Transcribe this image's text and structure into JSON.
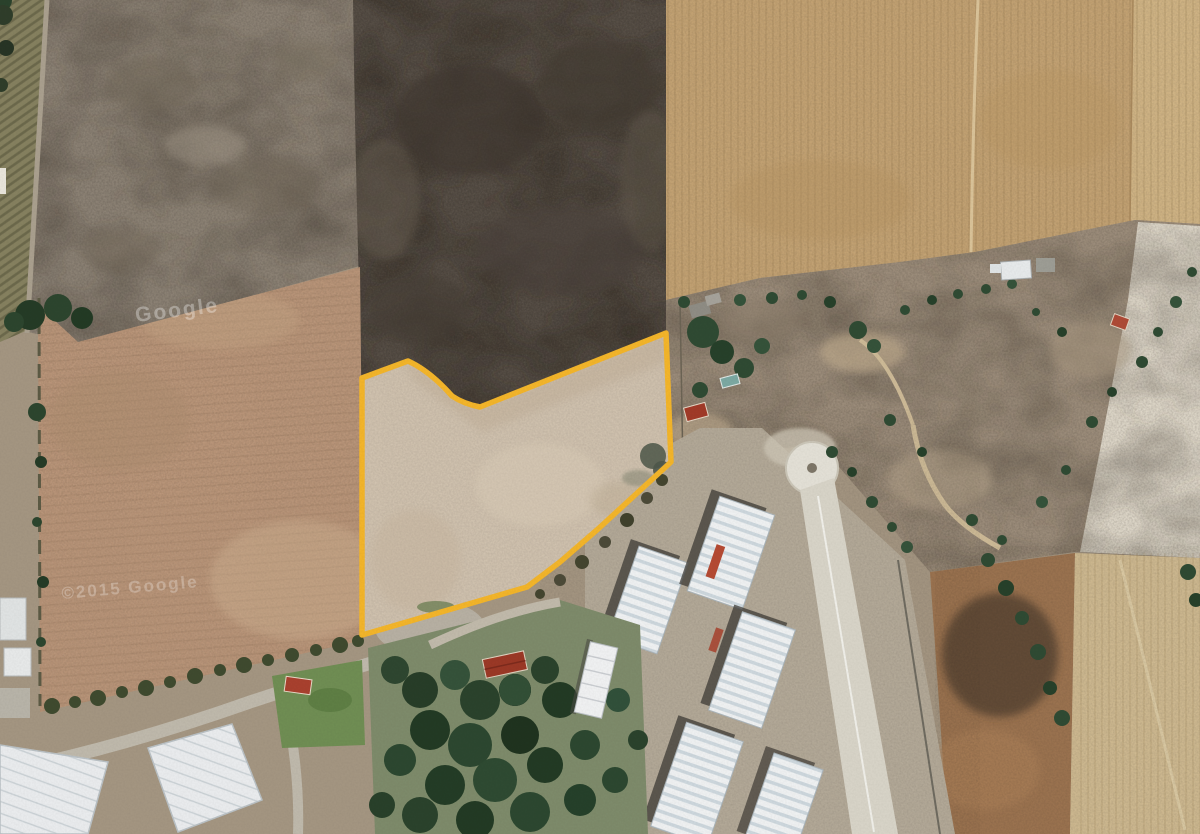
{
  "map": {
    "type": "satellite-imagery",
    "description": "Aerial/satellite view of agricultural land with an irregular parcel highlighted by a yellow boundary; surrounded by plowed fields, dark scrub field, scrubland with scattered trees, industrial warehouses, greenhouses and a wooded lot",
    "watermarks": [
      {
        "text": "Google",
        "position": "upper-left field",
        "style": "faint-white"
      },
      {
        "text": "©2015 Google",
        "position": "middle-left field",
        "style": "faint-white"
      }
    ],
    "parcel": {
      "outline_color": "#F2B42A",
      "outline_width_px": 5,
      "fill_color": "#CFC1AE",
      "shape": "irregular polygon with notch at top-left"
    },
    "palette": {
      "dark_scrub_field": "#544C44",
      "golden_field": "#C2A172",
      "plowed_brown_field": "#B79377",
      "gray_brown_field": "#8B8174",
      "scrubland": "#9C8D7B",
      "cleared_white_area": "#DDD6C8",
      "warehouse_roof": "#EEF0F1",
      "vegetation_dark_green": "#3A5739",
      "lawn_green": "#6F8D53",
      "concrete_pad": "#E2DFD5",
      "red_roof": "#A03A28"
    },
    "features": [
      "highlighted-parcel",
      "dark-scrub-field",
      "golden-plowed-fields",
      "brown-plowed-field",
      "gray-brown-field",
      "crop-row-strip",
      "scrubland-with-trees",
      "industrial-warehouses",
      "concrete-keyhole-pad",
      "greenhouses",
      "wooded-lot",
      "rural-houses"
    ]
  }
}
